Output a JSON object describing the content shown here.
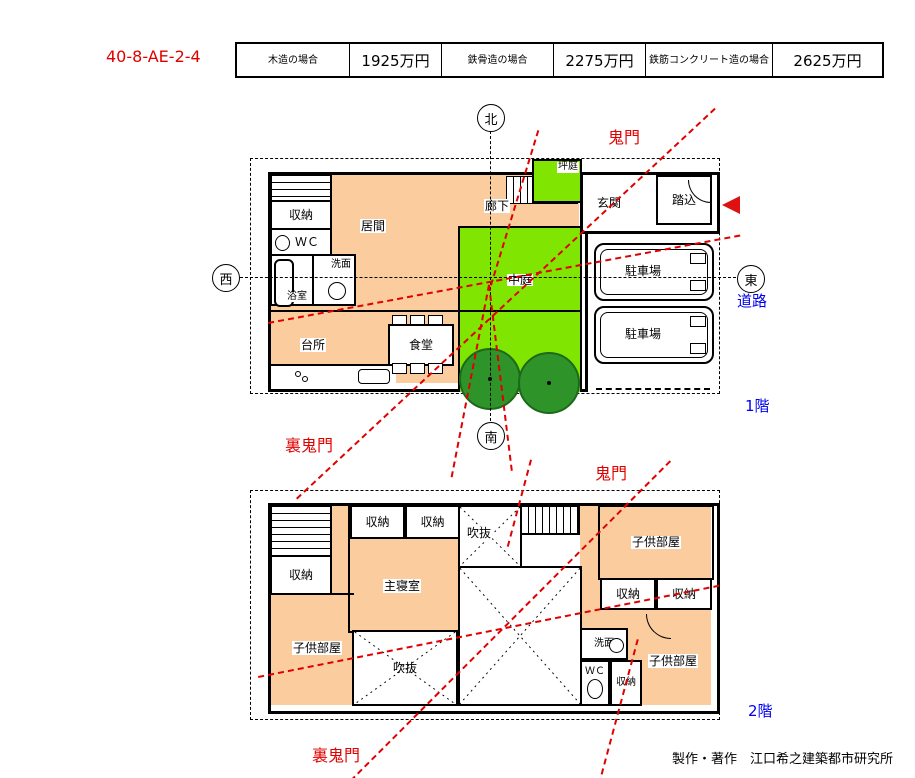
{
  "plan_id": "40-8-AE-2-4",
  "cost_table": [
    {
      "label": "木造の場合",
      "value": "1925万円"
    },
    {
      "label": "鉄骨造の場合",
      "value": "2275万円"
    },
    {
      "label": "鉄筋コンクリート造の場合",
      "value": "2625万円"
    }
  ],
  "compass": {
    "north": "北",
    "west": "西",
    "east": "東",
    "south": "南"
  },
  "annotations": {
    "kimon_f1": "鬼門",
    "ura_kimon_f1": "裏鬼門",
    "kimon_f2": "鬼門",
    "ura_kimon_f2": "裏鬼門",
    "road": "道路",
    "floor1": "1階",
    "floor2": "2階",
    "credit": "製作・著作　江口希之建築都市研究所"
  },
  "floor1": {
    "storage": "収納",
    "wc": "ＷＣ",
    "washroom": "洗面",
    "bath": "浴室",
    "living": "居間",
    "hall": "廊下",
    "tsuboniwa": "坪庭",
    "entrance": "玄関",
    "fumikomi": "踏込",
    "courtyard": "中庭",
    "parking1": "駐車場",
    "parking2": "駐車場",
    "kitchen": "台所",
    "dining": "食堂"
  },
  "floor2": {
    "storage_a": "収納",
    "storage_b": "収納",
    "storage_left": "収納",
    "void_top": "吹抜",
    "child_top": "子供部屋",
    "master": "主寝室",
    "storage_c": "収納",
    "storage_d": "収納",
    "child_left": "子供部屋",
    "void_center": "吹抜",
    "washroom": "洗面",
    "wc": "ＷＣ",
    "storage_e": "収納",
    "child_right": "子供部屋"
  },
  "colors": {
    "room_fill": "#FACC9E",
    "courtyard_fill": "#80E500",
    "tree_fill": "#2E9328",
    "accent_red": "#E10000",
    "accent_blue": "#0000F0"
  }
}
